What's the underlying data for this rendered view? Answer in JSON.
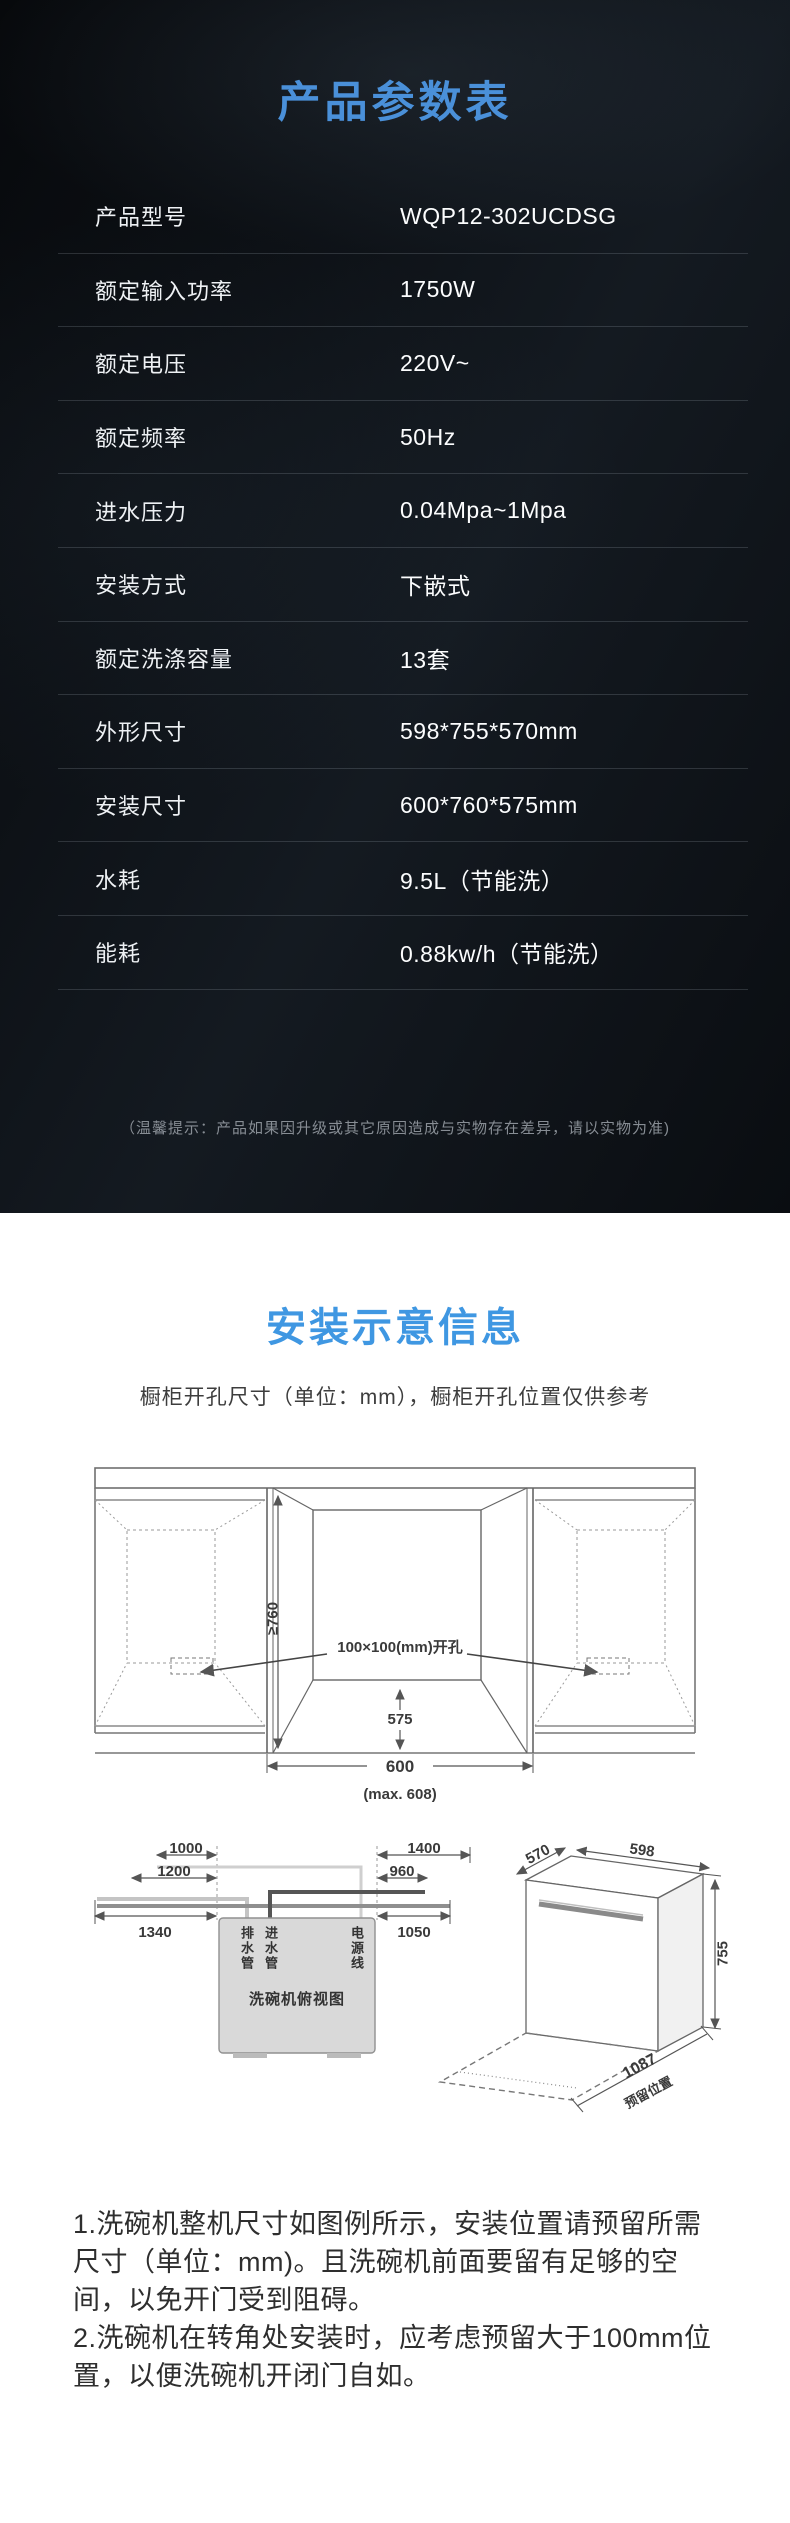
{
  "theme": {
    "dark_bg": "#0d1116",
    "light_bg": "#ffffff",
    "spec_title_blue": "#4a90d9",
    "install_title_blue": "#3f97e2",
    "divider": "rgba(210,220,230,0.17)"
  },
  "spec_section": {
    "title": "产品参数表",
    "rows": [
      {
        "label": "产品型号",
        "value": "WQP12-302UCDSG"
      },
      {
        "label": "额定输入功率",
        "value": "1750W"
      },
      {
        "label": "额定电压",
        "value": "220V~"
      },
      {
        "label": "额定频率",
        "value": "50Hz"
      },
      {
        "label": "进水压力",
        "value": "0.04Mpa~1Mpa"
      },
      {
        "label": "安装方式",
        "value": "下嵌式"
      },
      {
        "label": "额定洗涤容量",
        "value": "13套"
      },
      {
        "label": "外形尺寸",
        "value": "598*755*570mm"
      },
      {
        "label": "安装尺寸",
        "value": "600*760*575mm"
      },
      {
        "label": "水耗",
        "value": "9.5L（节能洗）"
      },
      {
        "label": "能耗",
        "value": "0.88kw/h（节能洗）"
      }
    ],
    "footnote": "（温馨提示：产品如果因升级或其它原因造成与实物存在差异，请以实物为准)"
  },
  "install_section": {
    "title": "安装示意信息",
    "subtitle": "橱柜开孔尺寸（单位：mm），橱柜开孔位置仅供参考",
    "cabinet_diagram": {
      "height_dim": "≥760",
      "hole_dim": "100×100(mm)开孔",
      "depth_dim": "575",
      "width_dim": "600",
      "width_max_dim": "(max. 608)"
    },
    "top_view_diagram": {
      "dim_1000": "1000",
      "dim_1200": "1200",
      "dim_1340": "1340",
      "dim_1400": "1400",
      "dim_960": "960",
      "dim_1050": "1050",
      "drain_label": "排水管",
      "inlet_label": "进水管",
      "power_label": "电源线",
      "caption": "洗碗机俯视图"
    },
    "side_view_diagram": {
      "depth_dim": "570",
      "width_dim": "598",
      "height_dim": "755",
      "reserve_dim": "1087",
      "reserve_label": "预留位置"
    },
    "notes": [
      "1.洗碗机整机尺寸如图例所示，安装位置请预留所需尺寸（单位：mm)。且洗碗机前面要留有足够的空间，以免开门受到阻碍。",
      "2.洗碗机在转角处安装时，应考虑预留大于100mm位置，以便洗碗机开闭门自如。"
    ]
  }
}
